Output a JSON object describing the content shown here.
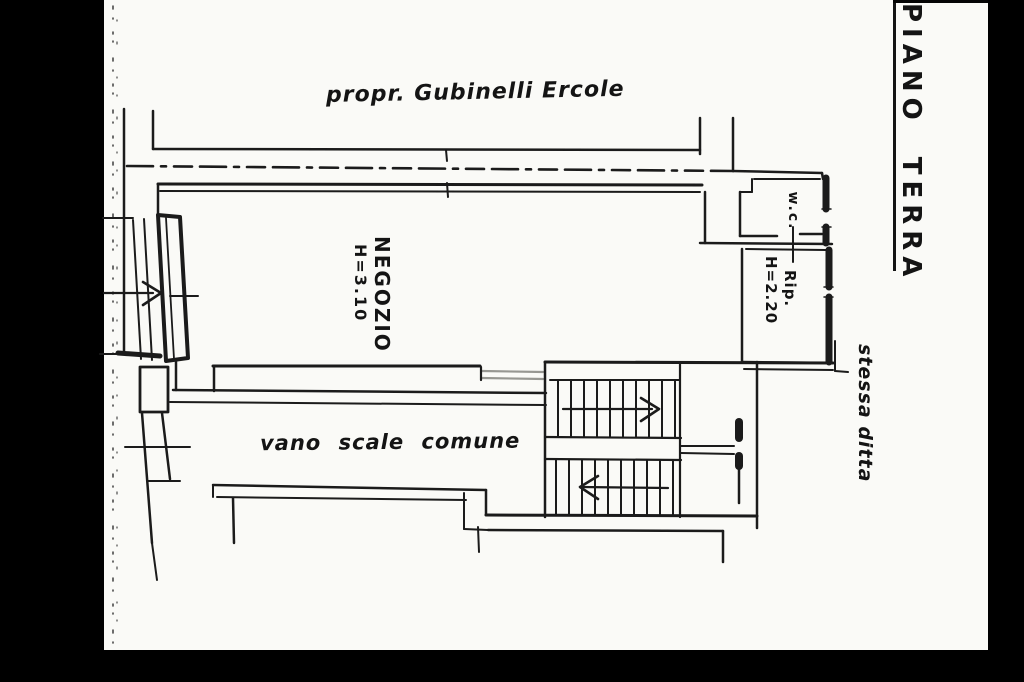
{
  "plan": {
    "floor_label": "PIANO TERRA",
    "owner_note": "propr. Gubinelli Ercole",
    "side_note": "stessa ditta",
    "rooms": {
      "shop": {
        "name": "NEGOZIO",
        "height": "H=3.10"
      },
      "wc": {
        "name": "w.c."
      },
      "storage": {
        "name": "Rip.",
        "height": "H=2.20"
      },
      "stairwell": {
        "name": "vano scale comune"
      }
    }
  },
  "colors": {
    "background": "#000000",
    "paper": "#fafaf7",
    "ink": "#1b1b1b",
    "door_opening_grey": "#979792"
  }
}
